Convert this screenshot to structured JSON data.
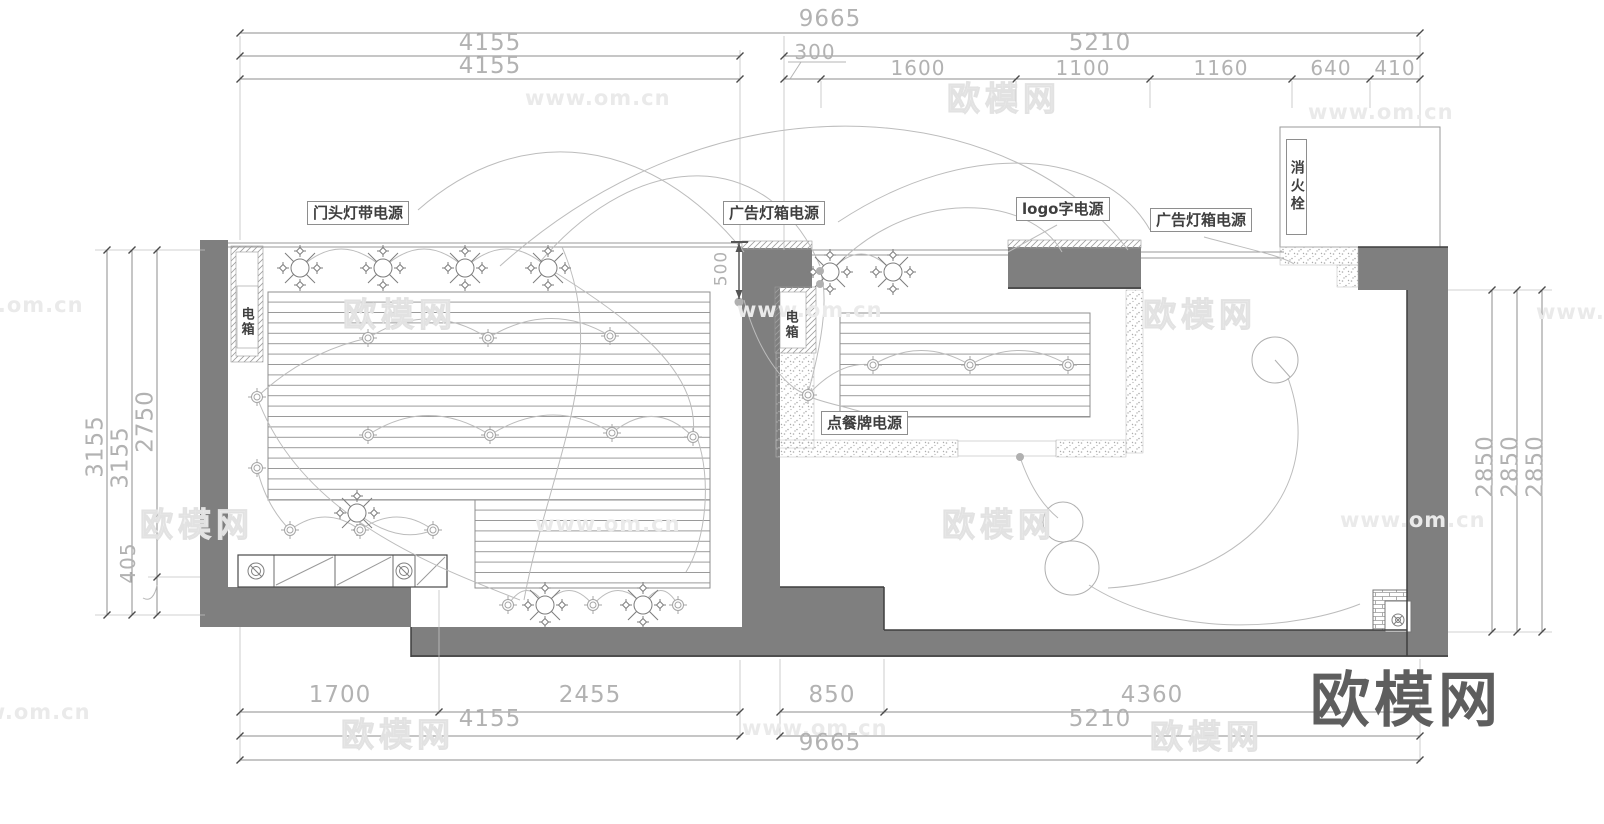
{
  "watermarks": {
    "site": "www.om.cn",
    "brand": "欧模网"
  },
  "logo": {
    "text": "欧模网"
  },
  "labels": {
    "door_strip_power": "门头灯带电源",
    "ad_lightbox_power_1": "广告灯箱电源",
    "logo_sign_power": "logo字电源",
    "ad_lightbox_power_2": "广告灯箱电源",
    "order_board_power": "点餐牌电源",
    "fire_hydrant": "消火栓",
    "electric_box": "电箱"
  },
  "dimensions": {
    "top": {
      "overall": "9665",
      "left_a": "4155",
      "left_b": "4155",
      "right_total": "5210",
      "seg_300": "300",
      "seg_1600": "1600",
      "seg_1100": "1100",
      "seg_1160": "1160",
      "seg_640": "640",
      "seg_410": "410"
    },
    "bottom": {
      "seg_1700": "1700",
      "seg_2455": "2455",
      "seg_850": "850",
      "seg_4360": "4360",
      "left_total": "4155",
      "right_total": "5210",
      "overall": "9665"
    },
    "left": {
      "outer": "3155",
      "middle": "3155",
      "upper": "2750",
      "lower": "405"
    },
    "right": {
      "d1": "2850",
      "d2": "2850",
      "d3": "2850"
    },
    "mid": {
      "storefront": "500"
    }
  }
}
